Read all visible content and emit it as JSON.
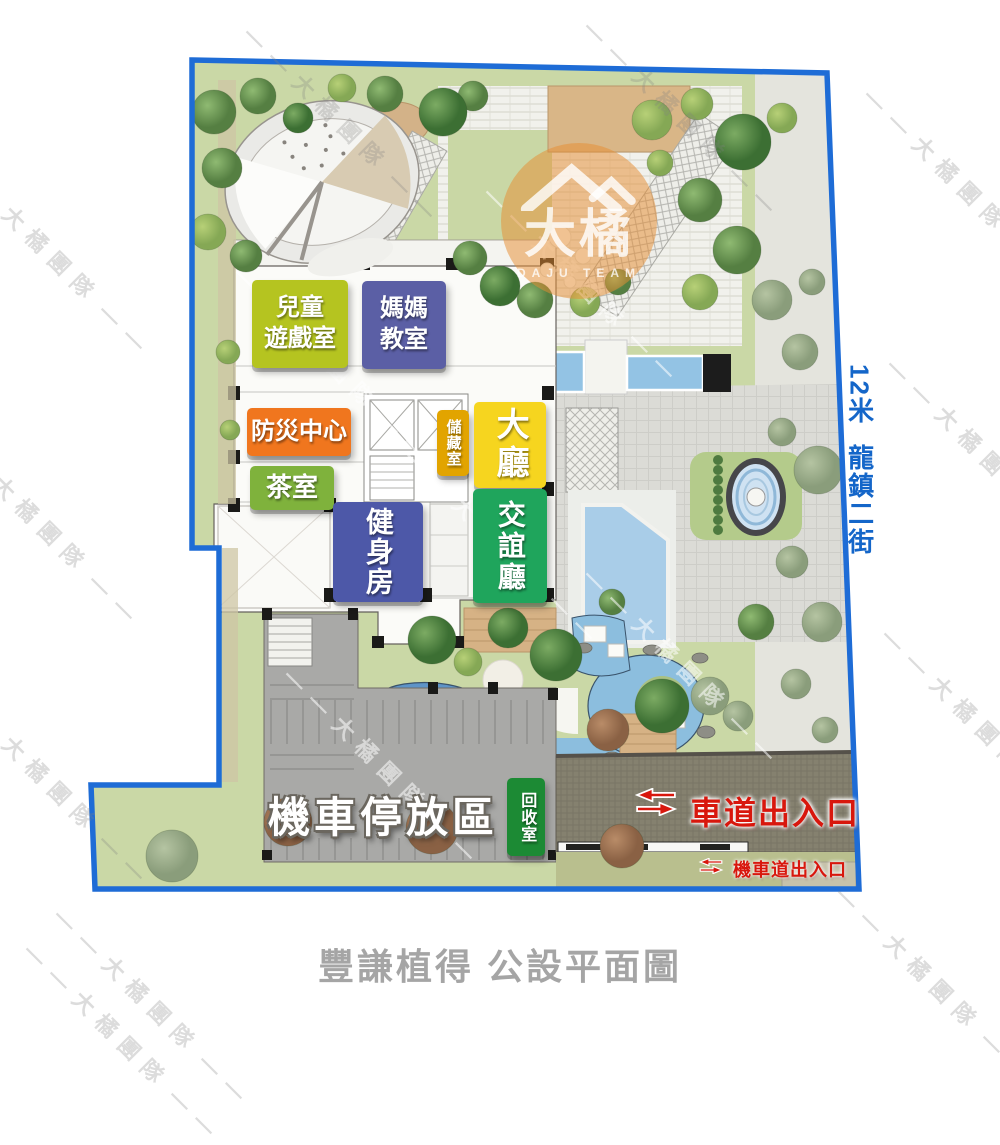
{
  "page": {
    "title": "豐謙植得 公設平面圖"
  },
  "watermark": {
    "text": "大橘團隊"
  },
  "logo": {
    "brand": "大橘",
    "team": "DAJU TEAM"
  },
  "street": {
    "width": "12米",
    "name": "龍鎮二街",
    "color": "#1466c9"
  },
  "rooms": [
    {
      "id": "kids-playroom",
      "label": "兒童\n遊戲室",
      "color": "#b5c420"
    },
    {
      "id": "mothers-classroom",
      "label": "媽媽\n教室",
      "color": "#5b5fa5"
    },
    {
      "id": "disaster-center",
      "label": "防災中心",
      "color": "#f0761e"
    },
    {
      "id": "tea-room",
      "label": "茶室",
      "color": "#7fb23c"
    },
    {
      "id": "storage-room",
      "label": "儲藏室",
      "color": "#e2a400"
    },
    {
      "id": "lobby",
      "label": "大廳",
      "color": "#f6d51f"
    },
    {
      "id": "social-hall",
      "label": "交誼廳",
      "color": "#1fa55c"
    },
    {
      "id": "gym",
      "label": "健身房",
      "color": "#4d58a8"
    },
    {
      "id": "recycle-room",
      "label": "回收室",
      "color": "#1c8a34"
    }
  ],
  "areas": {
    "motorcycle_parking": "機車停放區"
  },
  "entrances": {
    "car": "車道出入口",
    "motorcycle": "機車道出入口",
    "color": "#d8170d"
  },
  "colors": {
    "boundary": "#1e6cd6",
    "lawn": "#cad8a6",
    "title_gray": "#a5a5a5"
  }
}
